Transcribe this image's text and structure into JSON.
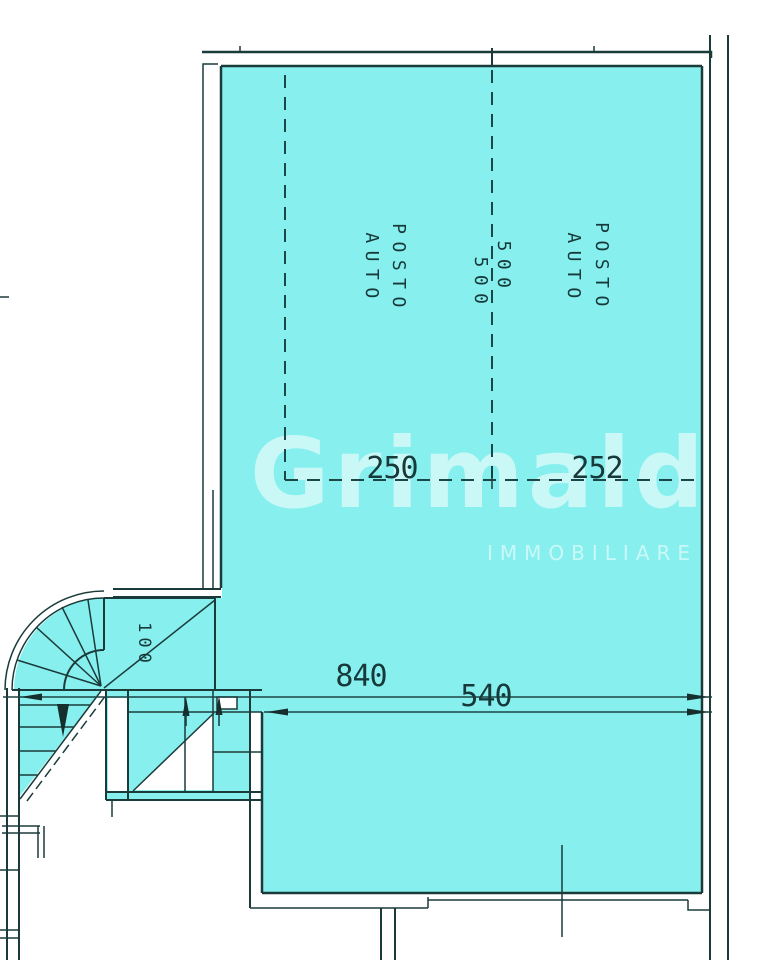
{
  "plan": {
    "labels": {
      "posto": "POSTO",
      "auto": "AUTO"
    },
    "dimensions": {
      "d500": "500",
      "d250": "250",
      "d252": "252",
      "d840": "840",
      "d540": "540",
      "d100": "100"
    },
    "watermark": {
      "brand": "Grimaldi",
      "subtitle": "IMMOBILIARE"
    },
    "colors": {
      "floor_fill": "#87F0EE",
      "line": "#1b3b3b",
      "watermark_white": "#ffffff"
    }
  }
}
